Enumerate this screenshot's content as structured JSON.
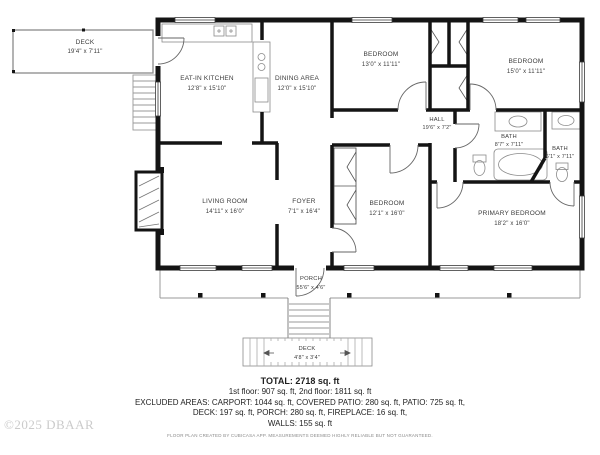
{
  "watermark": "©2025 DBAAR",
  "rooms": {
    "deck_top": {
      "name": "DECK",
      "dims": "19'4\" x 7'11\""
    },
    "eat_in_kitchen": {
      "name": "EAT-IN KITCHEN",
      "dims": "12'8\" x 15'10\""
    },
    "dining_area": {
      "name": "DINING AREA",
      "dims": "12'0\" x 15'10\""
    },
    "bedroom_1": {
      "name": "BEDROOM",
      "dims": "13'0\" x 11'11\""
    },
    "bedroom_2": {
      "name": "BEDROOM",
      "dims": "15'0\" x 11'11\""
    },
    "hall": {
      "name": "HALL",
      "dims": "19'6\" x 7'2\""
    },
    "bath_1": {
      "name": "BATH",
      "dims": "8'7\" x 7'11\""
    },
    "bath_2": {
      "name": "BATH",
      "dims": "6'1\" x 7'11\""
    },
    "living_room": {
      "name": "LIVING ROOM",
      "dims": "14'11\" x 16'0\""
    },
    "foyer": {
      "name": "FOYER",
      "dims": "7'1\" x 16'4\""
    },
    "bedroom_3": {
      "name": "BEDROOM",
      "dims": "12'1\" x 16'0\""
    },
    "primary_bedroom": {
      "name": "PRIMARY BEDROOM",
      "dims": "18'2\" x 16'0\""
    },
    "porch": {
      "name": "PORCH",
      "dims": "55'6\" x 4'6\""
    },
    "deck_bottom": {
      "name": "DECK",
      "dims": "4'8\" x 3'4\""
    }
  },
  "summary": {
    "total": "TOTAL: 2718 sq. ft",
    "floors": "1st floor: 907 sq. ft, 2nd floor: 1811 sq. ft",
    "excluded_1": "EXCLUDED AREAS: CARPORT: 1044 sq. ft, COVERED PATIO: 280 sq. ft, PATIO: 725 sq. ft,",
    "excluded_2": "DECK: 197 sq. ft, PORCH: 280 sq. ft, FIREPLACE: 16 sq. ft,",
    "excluded_3": "WALLS: 155 sq. ft"
  },
  "disclaimer": "FLOOR PLAN CREATED BY CUBICASA APP. MEASUREMENTS DEEMED HIGHLY RELIABLE BUT NOT GUARANTEED.",
  "colors": {
    "wall": "#141414",
    "light_structure": "#999999",
    "label": "#3c3c3c",
    "watermark": "#cbcbcb"
  }
}
